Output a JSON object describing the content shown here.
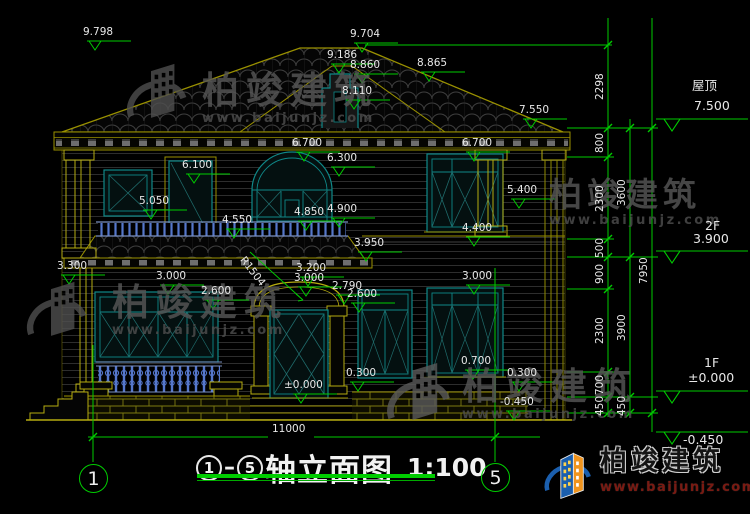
{
  "drawing": {
    "title": {
      "axis_a": "1",
      "axis_b": "5",
      "dash": "—",
      "name": "轴立面图",
      "scale": "1:100"
    },
    "axis_bubbles": {
      "left": "1",
      "right": "5"
    },
    "watermark": {
      "text": "柏竣建筑",
      "url": "www.baijunjz.com"
    },
    "logo": {
      "text": "柏竣建筑",
      "url": "www.baijunjz.com"
    },
    "colors": {
      "dimension_green": "#00cc00",
      "cad_yellow": "#b5ab10",
      "window_teal": "#0f8888",
      "baluster_blue": "#5577cc",
      "brand_blue": "#1b5fae",
      "brand_orange": "#f0941d",
      "url_red": "#7a1a12"
    },
    "dim_labels": [
      {
        "t": "9.798",
        "x": 83,
        "y": 27
      },
      {
        "t": "9.704",
        "x": 350,
        "y": 29
      },
      {
        "t": "9.186",
        "x": 327,
        "y": 50
      },
      {
        "t": "8.860",
        "x": 350,
        "y": 60
      },
      {
        "t": "8.865",
        "x": 417,
        "y": 58
      },
      {
        "t": "8.110",
        "x": 342,
        "y": 86
      },
      {
        "t": "7.550",
        "x": 519,
        "y": 105
      },
      {
        "t": "6.700",
        "x": 292,
        "y": 138
      },
      {
        "t": "6.700",
        "x": 462,
        "y": 138
      },
      {
        "t": "6.300",
        "x": 327,
        "y": 153
      },
      {
        "t": "6.100",
        "x": 182,
        "y": 160
      },
      {
        "t": "5.400",
        "x": 507,
        "y": 185
      },
      {
        "t": "5.050",
        "x": 139,
        "y": 196
      },
      {
        "t": "4.900",
        "x": 327,
        "y": 204
      },
      {
        "t": "4.850",
        "x": 294,
        "y": 207
      },
      {
        "t": "4.550",
        "x": 222,
        "y": 215
      },
      {
        "t": "4.400",
        "x": 462,
        "y": 223
      },
      {
        "t": "3.950",
        "x": 354,
        "y": 238
      },
      {
        "t": "3.300",
        "x": 57,
        "y": 261
      },
      {
        "t": "3.200",
        "x": 296,
        "y": 263
      },
      {
        "t": "3.000",
        "x": 294,
        "y": 273
      },
      {
        "t": "3.000",
        "x": 156,
        "y": 271
      },
      {
        "t": "3.000",
        "x": 462,
        "y": 271
      },
      {
        "t": "2.790",
        "x": 332,
        "y": 281
      },
      {
        "t": "2.600",
        "x": 347,
        "y": 289
      },
      {
        "t": "2.600",
        "x": 201,
        "y": 286
      },
      {
        "t": "R1504",
        "x": 246,
        "y": 255,
        "r": 52
      },
      {
        "t": "0.700",
        "x": 461,
        "y": 356
      },
      {
        "t": "0.300",
        "x": 346,
        "y": 368
      },
      {
        "t": "0.300",
        "x": 507,
        "y": 368
      },
      {
        "t": "±0.000",
        "x": 284,
        "y": 380
      },
      {
        "t": "-0.450",
        "x": 500,
        "y": 397
      },
      {
        "t": "11000",
        "x": 272,
        "y": 424
      },
      {
        "t": "屋顶",
        "x": 692,
        "y": 80,
        "cls": "lv"
      },
      {
        "t": "7.500",
        "x": 694,
        "y": 100,
        "cls": "lv"
      },
      {
        "t": "2F",
        "x": 705,
        "y": 220,
        "cls": "lv"
      },
      {
        "t": "3.900",
        "x": 693,
        "y": 233,
        "cls": "lv"
      },
      {
        "t": "1F",
        "x": 704,
        "y": 357,
        "cls": "lv"
      },
      {
        "t": "±0.000",
        "x": 688,
        "y": 372,
        "cls": "lv"
      },
      {
        "t": "-0.450",
        "x": 683,
        "y": 434,
        "cls": "lv"
      }
    ],
    "vertical_dims": [
      {
        "t": "2298",
        "x": 595,
        "y": 100
      },
      {
        "t": "800",
        "x": 595,
        "y": 153
      },
      {
        "t": "2300",
        "x": 595,
        "y": 212
      },
      {
        "t": "500",
        "x": 595,
        "y": 258
      },
      {
        "t": "900",
        "x": 595,
        "y": 284
      },
      {
        "t": "2300",
        "x": 595,
        "y": 344
      },
      {
        "t": "700",
        "x": 595,
        "y": 395
      },
      {
        "t": "450",
        "x": 595,
        "y": 416
      },
      {
        "t": "3600",
        "x": 617,
        "y": 206
      },
      {
        "t": "3900",
        "x": 617,
        "y": 341
      },
      {
        "t": "450",
        "x": 617,
        "y": 416
      },
      {
        "t": "7950",
        "x": 639,
        "y": 284
      }
    ]
  }
}
